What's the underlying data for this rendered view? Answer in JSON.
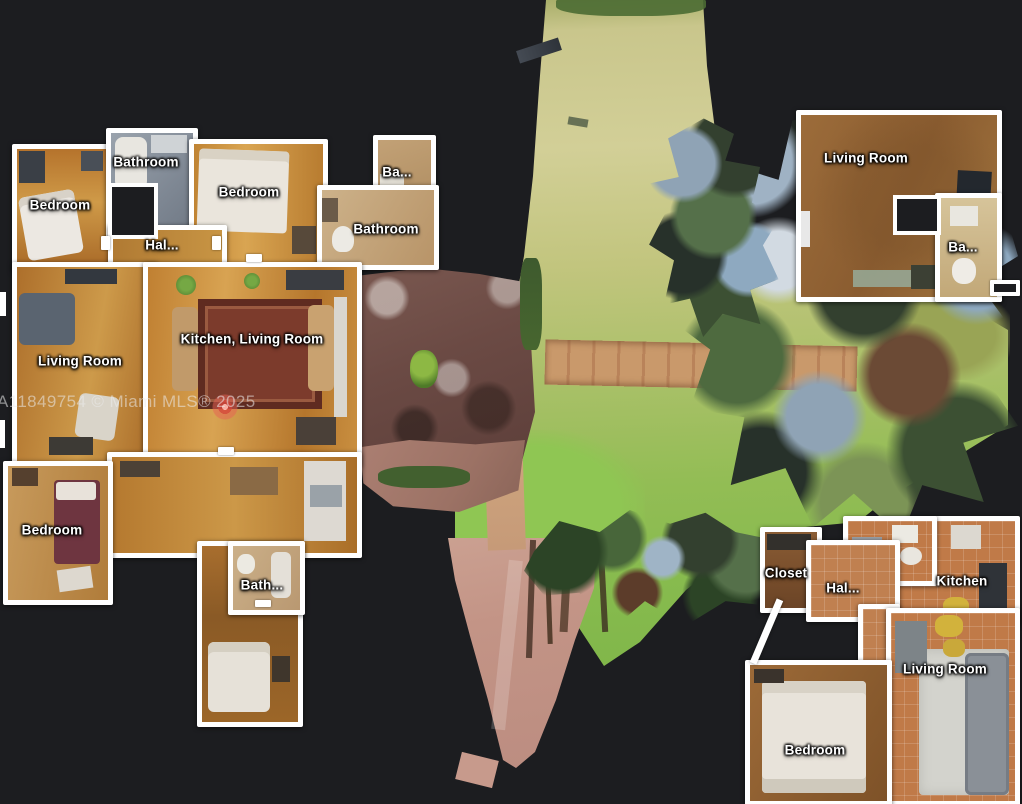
{
  "view": "3d-dollhouse-floorplan",
  "background_color": "#1c1d20",
  "watermark": {
    "text": "A11849754 © Miami MLS® 2025"
  },
  "marker": {
    "color": "#e25a52"
  },
  "floorplan": {
    "main_unit": {
      "bedroom_tl": "Bedroom",
      "bathroom_top": "Bathroom",
      "bedroom_center": "Bedroom",
      "ba_small": "Ba...",
      "bathroom_right": "Bathroom",
      "hall": "Hal...",
      "living_room": "Living Room",
      "kitchen_living": "Kitchen, Living Room",
      "bedroom_lower": "Bedroom",
      "bath_lower": "Bath..."
    },
    "upper_right_unit": {
      "living_room": "Living Room",
      "ba": "Ba..."
    },
    "lower_right_unit": {
      "closet": "Closet",
      "hall": "Hal...",
      "kitchen": "Kitchen",
      "living_room": "Living Room",
      "bedroom": "Bedroom"
    }
  }
}
